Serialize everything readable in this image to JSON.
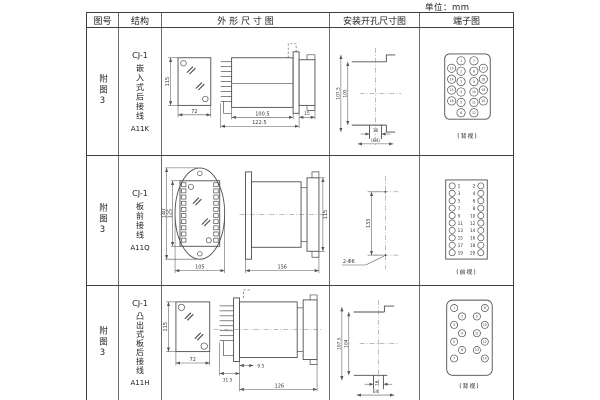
{
  "unit_label": "单位：mm",
  "table": {
    "headers": {
      "fig_no": "图号",
      "structure": "结构",
      "outline": "外 形 尺 寸 图",
      "mounting": "安装开孔尺寸图",
      "terminal": "端子图"
    },
    "rows": [
      {
        "fig_no": "附图3",
        "structure": {
          "model": "CJ-1",
          "desc": "嵌入式后接线",
          "code": "A11K"
        },
        "outline": {
          "front_height": "115",
          "front_width": "72",
          "body_len": "100.5",
          "total_len": "122.5",
          "bezel": "15"
        },
        "mounting": {
          "outer": "107.5",
          "inner": "105",
          "notch": "16",
          "span": "(64)"
        },
        "terminal": {
          "view": "(背视)",
          "numbers": [
            1,
            2,
            3,
            4,
            5,
            6,
            7,
            8,
            9,
            10,
            11,
            12,
            13,
            14,
            15,
            16,
            17,
            18,
            19,
            20
          ]
        }
      },
      {
        "fig_no": "附图3",
        "structure": {
          "model": "CJ-1",
          "desc": "板前接线",
          "code": "A11Q"
        },
        "outline": {
          "outer_height": "140",
          "inner_height": "125",
          "front_width": "105",
          "side_length": "156",
          "side_height": "115"
        },
        "mounting": {
          "spacing": "133",
          "holes": "2-Φ6"
        },
        "terminal": {
          "view": "(前视)",
          "left_numbers": [
            1,
            3,
            5,
            7,
            9,
            11,
            13,
            15,
            17,
            19
          ],
          "right_numbers": [
            2,
            4,
            6,
            8,
            10,
            12,
            14,
            16,
            18,
            20
          ]
        }
      },
      {
        "fig_no": "附图3",
        "structure": {
          "model": "CJ-1",
          "desc": "凸出式板后接线",
          "code": "A11H"
        },
        "outline": {
          "front_height": "115",
          "front_width": "72",
          "front_len": "31.5",
          "panel": "9.5",
          "total_len": "126"
        },
        "mounting": {
          "outer": "107.5",
          "inner": "104",
          "notch": "16",
          "span": "64"
        },
        "terminal": {
          "view": "(背视)",
          "numbers": [
            1,
            2,
            3,
            4,
            5,
            6,
            7,
            8,
            9,
            10,
            11,
            12,
            13,
            14
          ]
        }
      }
    ]
  }
}
